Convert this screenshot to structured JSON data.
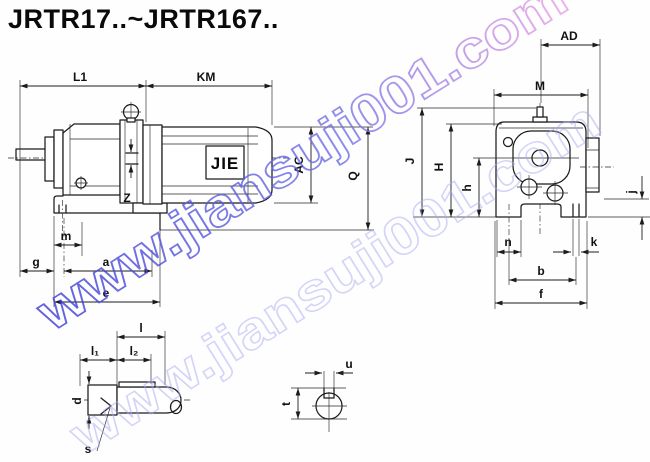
{
  "title": "JRTR17..~JRTR167..",
  "watermark": {
    "text": "www.jiansuji001.com",
    "color_start": "#3b3bd8",
    "color_mid": "#6e6ee6",
    "color_end": "#e9a0e6",
    "color_secondary": "#aaabf2"
  },
  "motor_logo": "JIE",
  "side_view": {
    "dims": {
      "L1": "L1",
      "KM": "KM",
      "AC": "AC",
      "Q": "Q",
      "Z": "Z",
      "m": "m",
      "g": "g",
      "a": "a",
      "e": "e"
    }
  },
  "front_view": {
    "dims": {
      "AD": "AD",
      "M": "M",
      "J": "J",
      "H": "H",
      "h": "h",
      "j": "j",
      "n": "n",
      "k": "k",
      "b": "b",
      "f": "f"
    }
  },
  "shaft_detail": {
    "dims": {
      "l": "l",
      "l1": "l₁",
      "l2": "l₂",
      "d": "d",
      "s": "s"
    }
  },
  "keyway_detail": {
    "dims": {
      "u": "u",
      "t": "t"
    }
  }
}
